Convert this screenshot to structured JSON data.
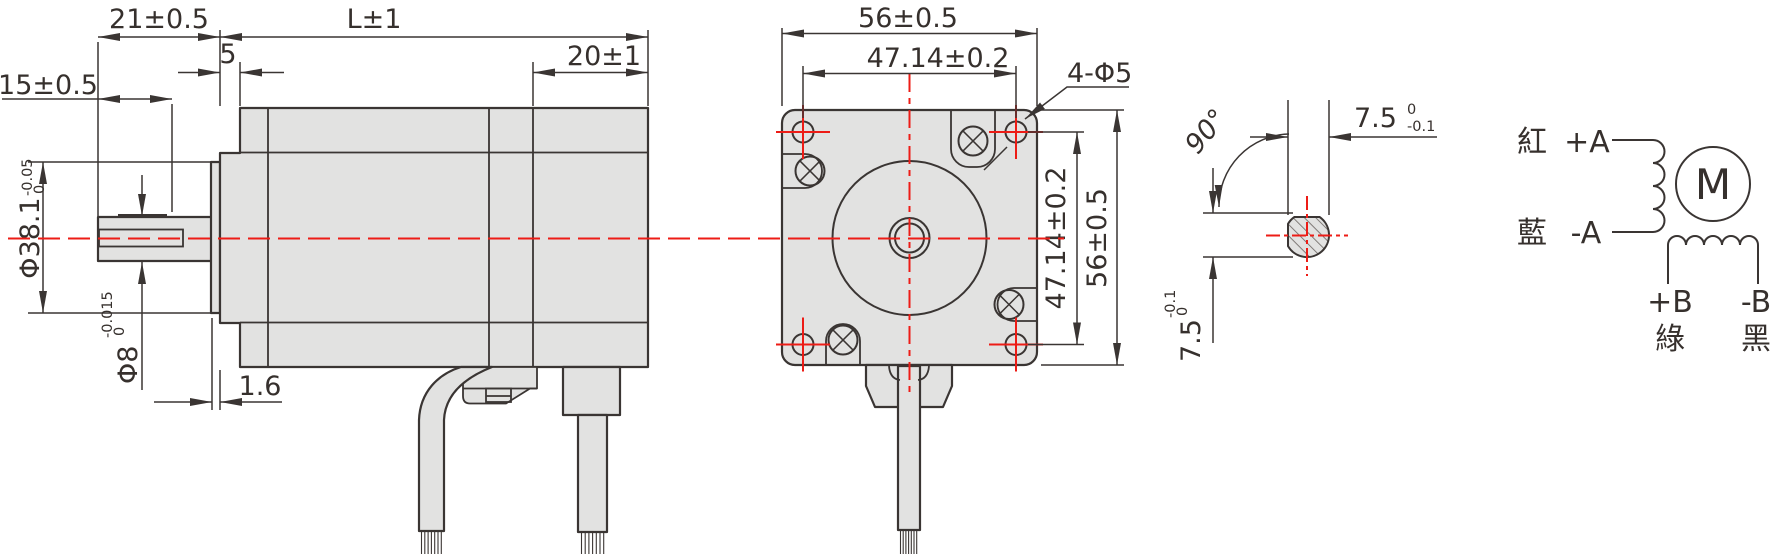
{
  "drawing": {
    "type": "stepper-motor-dimension-drawing",
    "colors": {
      "line": "#3a3533",
      "fill": "#e2e2e1",
      "accent_red": "#ed1c16",
      "background": "#ffffff"
    },
    "side_view": {
      "shaft_length": "21±0.5",
      "body_length": "L±1",
      "pilot_step": "5",
      "rear_cap_length": "20±1",
      "flat_length": "15±0.5",
      "pilot_diameter": {
        "value": "Φ38.1",
        "tol_upper": "0",
        "tol_lower": "-0.05"
      },
      "shaft_diameter": {
        "value": "Φ8",
        "tol_upper": "0",
        "tol_lower": "-0.015"
      },
      "flange_thickness": "1.6"
    },
    "front_view": {
      "width": "56±0.5",
      "hole_spacing_h": "47.14±0.2",
      "hole_callout": "4-Φ5",
      "hole_spacing_v": "47.14±0.2",
      "height": "56±0.5"
    },
    "shaft_section": {
      "flat_angle": "90°",
      "flat_width": {
        "value": "7.5",
        "tol_upper": "0",
        "tol_lower": "-0.1"
      },
      "flat_height": {
        "value": "7.5",
        "tol_upper": "0",
        "tol_lower": "-0.1"
      }
    },
    "wiring": {
      "motor_symbol": "M",
      "phase_a": {
        "plus_color": "紅",
        "plus_label": "+A",
        "minus_color": "藍",
        "minus_label": "-A"
      },
      "phase_b": {
        "plus_label": "+B",
        "plus_color": "綠",
        "minus_label": "-B",
        "minus_color": "黑"
      }
    }
  }
}
